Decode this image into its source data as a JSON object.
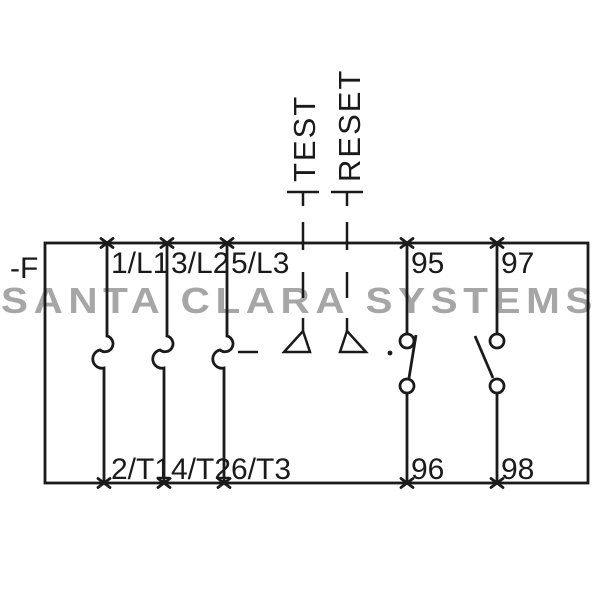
{
  "watermark": {
    "text": "SANTA CLARA SYSTEMS"
  },
  "relay": {
    "designator": "-F",
    "test_button": "TEST",
    "reset_button": "RESET",
    "main_poles": [
      {
        "top_terminal": "1/L1",
        "bottom_terminal": "2/T1"
      },
      {
        "top_terminal": "3/L2",
        "bottom_terminal": "4/T2"
      },
      {
        "top_terminal": "5/L3",
        "bottom_terminal": "6/T3"
      }
    ],
    "aux_contacts": [
      {
        "top_terminal": "95",
        "bottom_terminal": "96"
      },
      {
        "top_terminal": "97",
        "bottom_terminal": "98"
      }
    ]
  },
  "colors": {
    "line": "#1a1a1a",
    "watermark": "#a6a6a6",
    "background": "#ffffff"
  }
}
